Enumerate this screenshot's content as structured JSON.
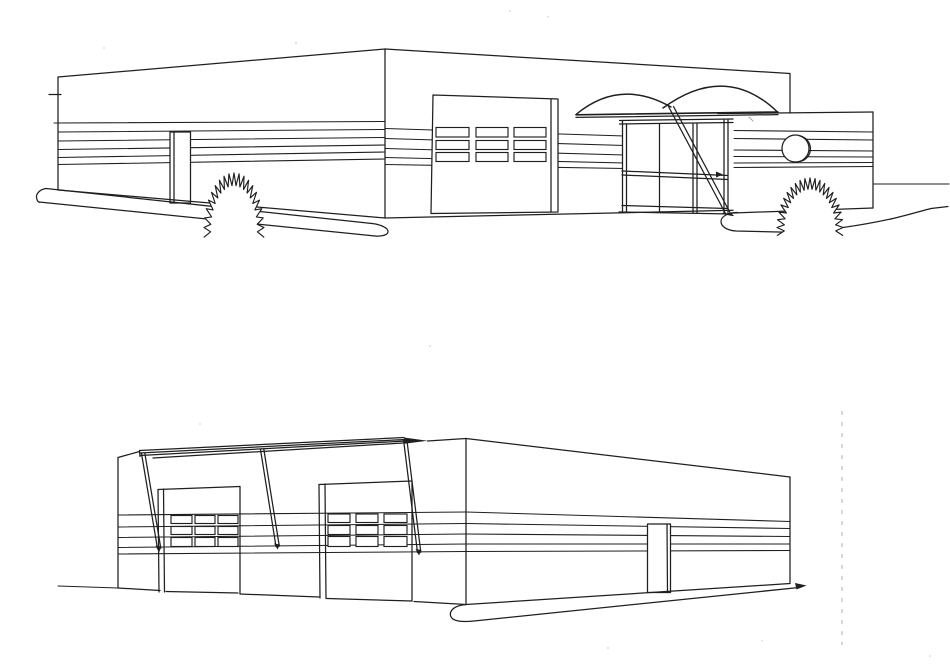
{
  "canvas": {
    "background_color": "#ffffff",
    "ink_color": "#1f1f1f",
    "width_px": 950,
    "height_px": 669,
    "media": "scanned hand-drawn architectural line sketch, no text or captions visible"
  },
  "sketches": [
    {
      "id": "upper-perspective-view",
      "position": "top half of sheet",
      "depicts": "one-story flat-roof commercial building seen from front-left corner",
      "elements": [
        "flat-roof-massing",
        "horizontal-window-band-stripes",
        "narrow-service-door-left-facade",
        "sectional-overhead-door-with-3x3-lites",
        "curved-double-arc-entrance-canopy",
        "glass-storefront-entrance-with-mullions",
        "diagonal-canopy-brace",
        "low-right-wing-with-round-porthole-window",
        "spiky-shrub-left",
        "spiky-shrub-right",
        "rounded-sidewalk-curbs",
        "ground-line-right"
      ]
    },
    {
      "id": "lower-perspective-view",
      "position": "bottom half of sheet",
      "depicts": "same building seen from opposite front corner",
      "elements": [
        "flat-roof-massing",
        "thin-projecting-canopy-slab",
        "three-angled-canopy-struts",
        "overhead-door-1-with-3x3-lites",
        "overhead-door-2-with-3x3-lites",
        "horizontal-window-band-stripes",
        "narrow-service-door-right-facade",
        "rounded-sidewalk-curb-with-pointed-end",
        "ground-line-left",
        "vertical-fold-crease-mark"
      ]
    }
  ]
}
